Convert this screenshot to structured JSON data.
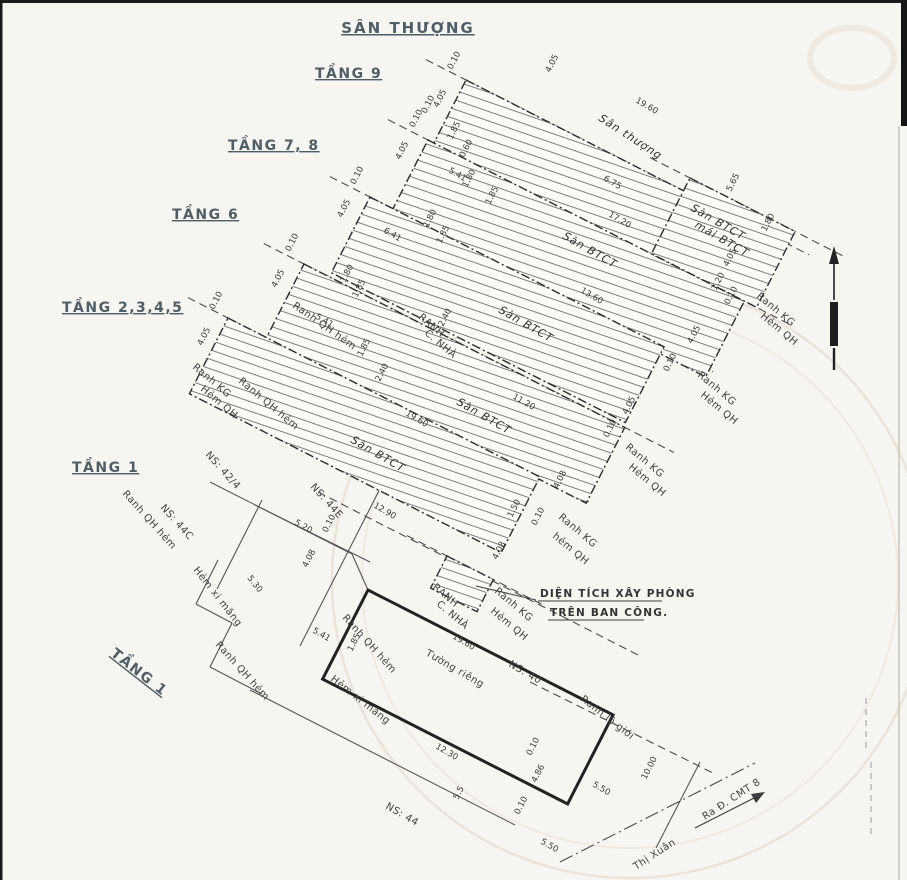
{
  "title": "SÂN THƯỢNG",
  "floors": [
    {
      "text": "TẦNG 9"
    },
    {
      "text": "TẦNG 7, 8"
    },
    {
      "text": "TẦNG 6"
    },
    {
      "text": "TẦNG 2,3,4,5"
    },
    {
      "text": "TẦNG 1"
    },
    {
      "text": "TẦNG 1"
    }
  ],
  "callout": {
    "line1": "DIỆN TÍCH XÂY PHÒNG",
    "line2": "TRÊN BAN CÔNG."
  },
  "slab_texts": [
    {
      "text": "Sân thượng",
      "x": 598,
      "y": 120,
      "rot": 33
    },
    {
      "text": "Sàn BTCT",
      "x": 562,
      "y": 238,
      "rot": 30
    },
    {
      "text": "Sàn BTCT",
      "x": 690,
      "y": 210,
      "rot": 30
    },
    {
      "text": "mái BTCT",
      "x": 694,
      "y": 227,
      "rot": 30
    },
    {
      "text": "Sàn BTCT",
      "x": 498,
      "y": 312,
      "rot": 30
    },
    {
      "text": "Sàn BTCT",
      "x": 456,
      "y": 404,
      "rot": 30
    },
    {
      "text": "Sàn BTCT",
      "x": 350,
      "y": 442,
      "rot": 30
    }
  ],
  "boundary_labels": [
    {
      "text": "Ranh KG",
      "x": 192,
      "y": 368,
      "rot": 40
    },
    {
      "text": "Hẻm QH",
      "x": 200,
      "y": 390,
      "rot": 40
    },
    {
      "text": "Ranh QH hẻm",
      "x": 292,
      "y": 307,
      "rot": 35
    },
    {
      "text": "Ranh QH hẻm",
      "x": 238,
      "y": 382,
      "rot": 40
    },
    {
      "text": "Ranh KG",
      "x": 697,
      "y": 376,
      "rot": 40
    },
    {
      "text": "Hẻm QH",
      "x": 700,
      "y": 396,
      "rot": 40
    },
    {
      "text": "Ranh KG",
      "x": 756,
      "y": 297,
      "rot": 40
    },
    {
      "text": "Hẻm QH",
      "x": 760,
      "y": 317,
      "rot": 40
    },
    {
      "text": "Ranh KG",
      "x": 625,
      "y": 448,
      "rot": 40
    },
    {
      "text": "Hẻm QH",
      "x": 628,
      "y": 468,
      "rot": 40
    },
    {
      "text": "Ranh KG",
      "x": 558,
      "y": 518,
      "rot": 40
    },
    {
      "text": "hẻm QH",
      "x": 552,
      "y": 537,
      "rot": 40
    },
    {
      "text": "Ranh KG",
      "x": 494,
      "y": 592,
      "rot": 40
    },
    {
      "text": "Hẻm QH",
      "x": 490,
      "y": 612,
      "rot": 40
    },
    {
      "text": "RANH",
      "x": 432,
      "y": 588,
      "rot": 40,
      "size": 8
    },
    {
      "text": "C. NHÀ",
      "x": 436,
      "y": 605,
      "rot": 40,
      "size": 8
    },
    {
      "text": "RANH",
      "x": 418,
      "y": 318,
      "rot": 40,
      "size": 8
    },
    {
      "text": "C. NHÀ",
      "x": 424,
      "y": 334,
      "rot": 40,
      "size": 8
    },
    {
      "text": "NS: 42/4",
      "x": 205,
      "y": 455,
      "rot": 48
    },
    {
      "text": "NS: 44C",
      "x": 160,
      "y": 508,
      "rot": 48
    },
    {
      "text": "NS: 44E",
      "x": 310,
      "y": 487,
      "rot": 48
    },
    {
      "text": "Ranh QH hẻm",
      "x": 122,
      "y": 494,
      "rot": 48
    },
    {
      "text": "Hẻm xi măng",
      "x": 193,
      "y": 570,
      "rot": 52
    },
    {
      "text": "Ranh QH hẻm",
      "x": 215,
      "y": 645,
      "rot": 48
    },
    {
      "text": "Ranh QH hẻm",
      "x": 342,
      "y": 618,
      "rot": 48
    },
    {
      "text": "Hẻm xi măng",
      "x": 330,
      "y": 680,
      "rot": 38
    },
    {
      "text": "NS: 40",
      "x": 508,
      "y": 666,
      "rot": 30
    },
    {
      "text": "Tường riêng",
      "x": 425,
      "y": 655,
      "rot": 30
    },
    {
      "text": "NS: 44",
      "x": 385,
      "y": 808,
      "rot": 30
    },
    {
      "text": "Ranh lộ giới",
      "x": 580,
      "y": 700,
      "rot": 38
    },
    {
      "text": "Ra Đ. CMT 8",
      "x": 705,
      "y": 820,
      "rot": -33,
      "size": 11
    },
    {
      "text": "Thị Xuân",
      "x": 636,
      "y": 870,
      "rot": -33
    }
  ],
  "dim_labels": [
    {
      "text": "0.10",
      "x": 452,
      "y": 70,
      "rot": -63
    },
    {
      "text": "4.05",
      "x": 438,
      "y": 108,
      "rot": -63
    },
    {
      "text": "1.85",
      "x": 452,
      "y": 140,
      "rot": -63
    },
    {
      "text": "0.60",
      "x": 464,
      "y": 158,
      "rot": -63
    },
    {
      "text": "4.05",
      "x": 550,
      "y": 73,
      "rot": -63
    },
    {
      "text": "19.60",
      "x": 635,
      "y": 102,
      "rot": 30
    },
    {
      "text": "6.75",
      "x": 603,
      "y": 180,
      "rot": 30
    },
    {
      "text": "0.10",
      "x": 414,
      "y": 128,
      "rot": -63
    },
    {
      "text": "0.10",
      "x": 426,
      "y": 114,
      "rot": -63
    },
    {
      "text": "4.05",
      "x": 400,
      "y": 160,
      "rot": -63
    },
    {
      "text": "5.41",
      "x": 448,
      "y": 172,
      "rot": 30
    },
    {
      "text": "1.80",
      "x": 467,
      "y": 188,
      "rot": -63
    },
    {
      "text": "1.85",
      "x": 490,
      "y": 205,
      "rot": -63
    },
    {
      "text": "17.20",
      "x": 608,
      "y": 216,
      "rot": 30
    },
    {
      "text": "13.60",
      "x": 580,
      "y": 292,
      "rot": 30
    },
    {
      "text": "5.65",
      "x": 731,
      "y": 192,
      "rot": -63
    },
    {
      "text": "1.80",
      "x": 766,
      "y": 232,
      "rot": -63
    },
    {
      "text": "4.05",
      "x": 728,
      "y": 267,
      "rot": -63
    },
    {
      "text": "1.20",
      "x": 716,
      "y": 291,
      "rot": -63
    },
    {
      "text": "0.10",
      "x": 729,
      "y": 305,
      "rot": -63
    },
    {
      "text": "0.10",
      "x": 355,
      "y": 185,
      "rot": -63
    },
    {
      "text": "4.05",
      "x": 342,
      "y": 218,
      "rot": -63
    },
    {
      "text": "6.41",
      "x": 383,
      "y": 232,
      "rot": 30
    },
    {
      "text": "1.80",
      "x": 428,
      "y": 228,
      "rot": -63
    },
    {
      "text": "1.85",
      "x": 441,
      "y": 244,
      "rot": -63
    },
    {
      "text": "11.20",
      "x": 512,
      "y": 398,
      "rot": 30
    },
    {
      "text": "4.05",
      "x": 692,
      "y": 344,
      "rot": -63
    },
    {
      "text": "0.10",
      "x": 668,
      "y": 372,
      "rot": -63
    },
    {
      "text": "0.10",
      "x": 290,
      "y": 252,
      "rot": -63
    },
    {
      "text": "4.05",
      "x": 276,
      "y": 288,
      "rot": -63
    },
    {
      "text": "1.80",
      "x": 345,
      "y": 283,
      "rot": -63
    },
    {
      "text": "1.85",
      "x": 357,
      "y": 298,
      "rot": -63
    },
    {
      "text": "4.05",
      "x": 627,
      "y": 415,
      "rot": -63
    },
    {
      "text": "0.10",
      "x": 608,
      "y": 438,
      "rot": -63
    },
    {
      "text": "0.10",
      "x": 214,
      "y": 310,
      "rot": -63
    },
    {
      "text": "4.05",
      "x": 202,
      "y": 346,
      "rot": -63
    },
    {
      "text": "5.41",
      "x": 315,
      "y": 318,
      "rot": 30
    },
    {
      "text": "1.85",
      "x": 362,
      "y": 357,
      "rot": -63
    },
    {
      "text": "2.40",
      "x": 380,
      "y": 382,
      "rot": -63
    },
    {
      "text": "2.40",
      "x": 443,
      "y": 327,
      "rot": -63
    },
    {
      "text": "19.60",
      "x": 405,
      "y": 415,
      "rot": 30
    },
    {
      "text": "4.08",
      "x": 558,
      "y": 489,
      "rot": -63
    },
    {
      "text": "0.10",
      "x": 536,
      "y": 526,
      "rot": -63
    },
    {
      "text": "1.50",
      "x": 512,
      "y": 518,
      "rot": -63
    },
    {
      "text": "4.08",
      "x": 497,
      "y": 560,
      "rot": -63
    },
    {
      "text": "12.90",
      "x": 373,
      "y": 507,
      "rot": 30
    },
    {
      "text": "5.20",
      "x": 294,
      "y": 524,
      "rot": 30
    },
    {
      "text": "0.10",
      "x": 327,
      "y": 533,
      "rot": -63
    },
    {
      "text": "4.08",
      "x": 307,
      "y": 568,
      "rot": -63
    },
    {
      "text": "5.30",
      "x": 247,
      "y": 578,
      "rot": 52
    },
    {
      "text": "5.41",
      "x": 312,
      "y": 632,
      "rot": 30
    },
    {
      "text": "1.85",
      "x": 352,
      "y": 652,
      "rot": -63
    },
    {
      "text": "19.60",
      "x": 452,
      "y": 638,
      "rot": 30
    },
    {
      "text": "12.30",
      "x": 435,
      "y": 748,
      "rot": 30
    },
    {
      "text": "5.5",
      "x": 458,
      "y": 800,
      "rot": -63
    },
    {
      "text": "0.10",
      "x": 531,
      "y": 756,
      "rot": -63
    },
    {
      "text": "4.86",
      "x": 536,
      "y": 783,
      "rot": -63
    },
    {
      "text": "0.10",
      "x": 519,
      "y": 815,
      "rot": -63
    },
    {
      "text": "5.50",
      "x": 592,
      "y": 786,
      "rot": 30
    },
    {
      "text": "5.50",
      "x": 540,
      "y": 843,
      "rot": 30
    },
    {
      "text": "10.00",
      "x": 646,
      "y": 780,
      "rot": -63
    }
  ],
  "colors": {
    "paper": "#f7f5ef",
    "ink": "#3d3d3d",
    "header": "#4d5e68"
  }
}
